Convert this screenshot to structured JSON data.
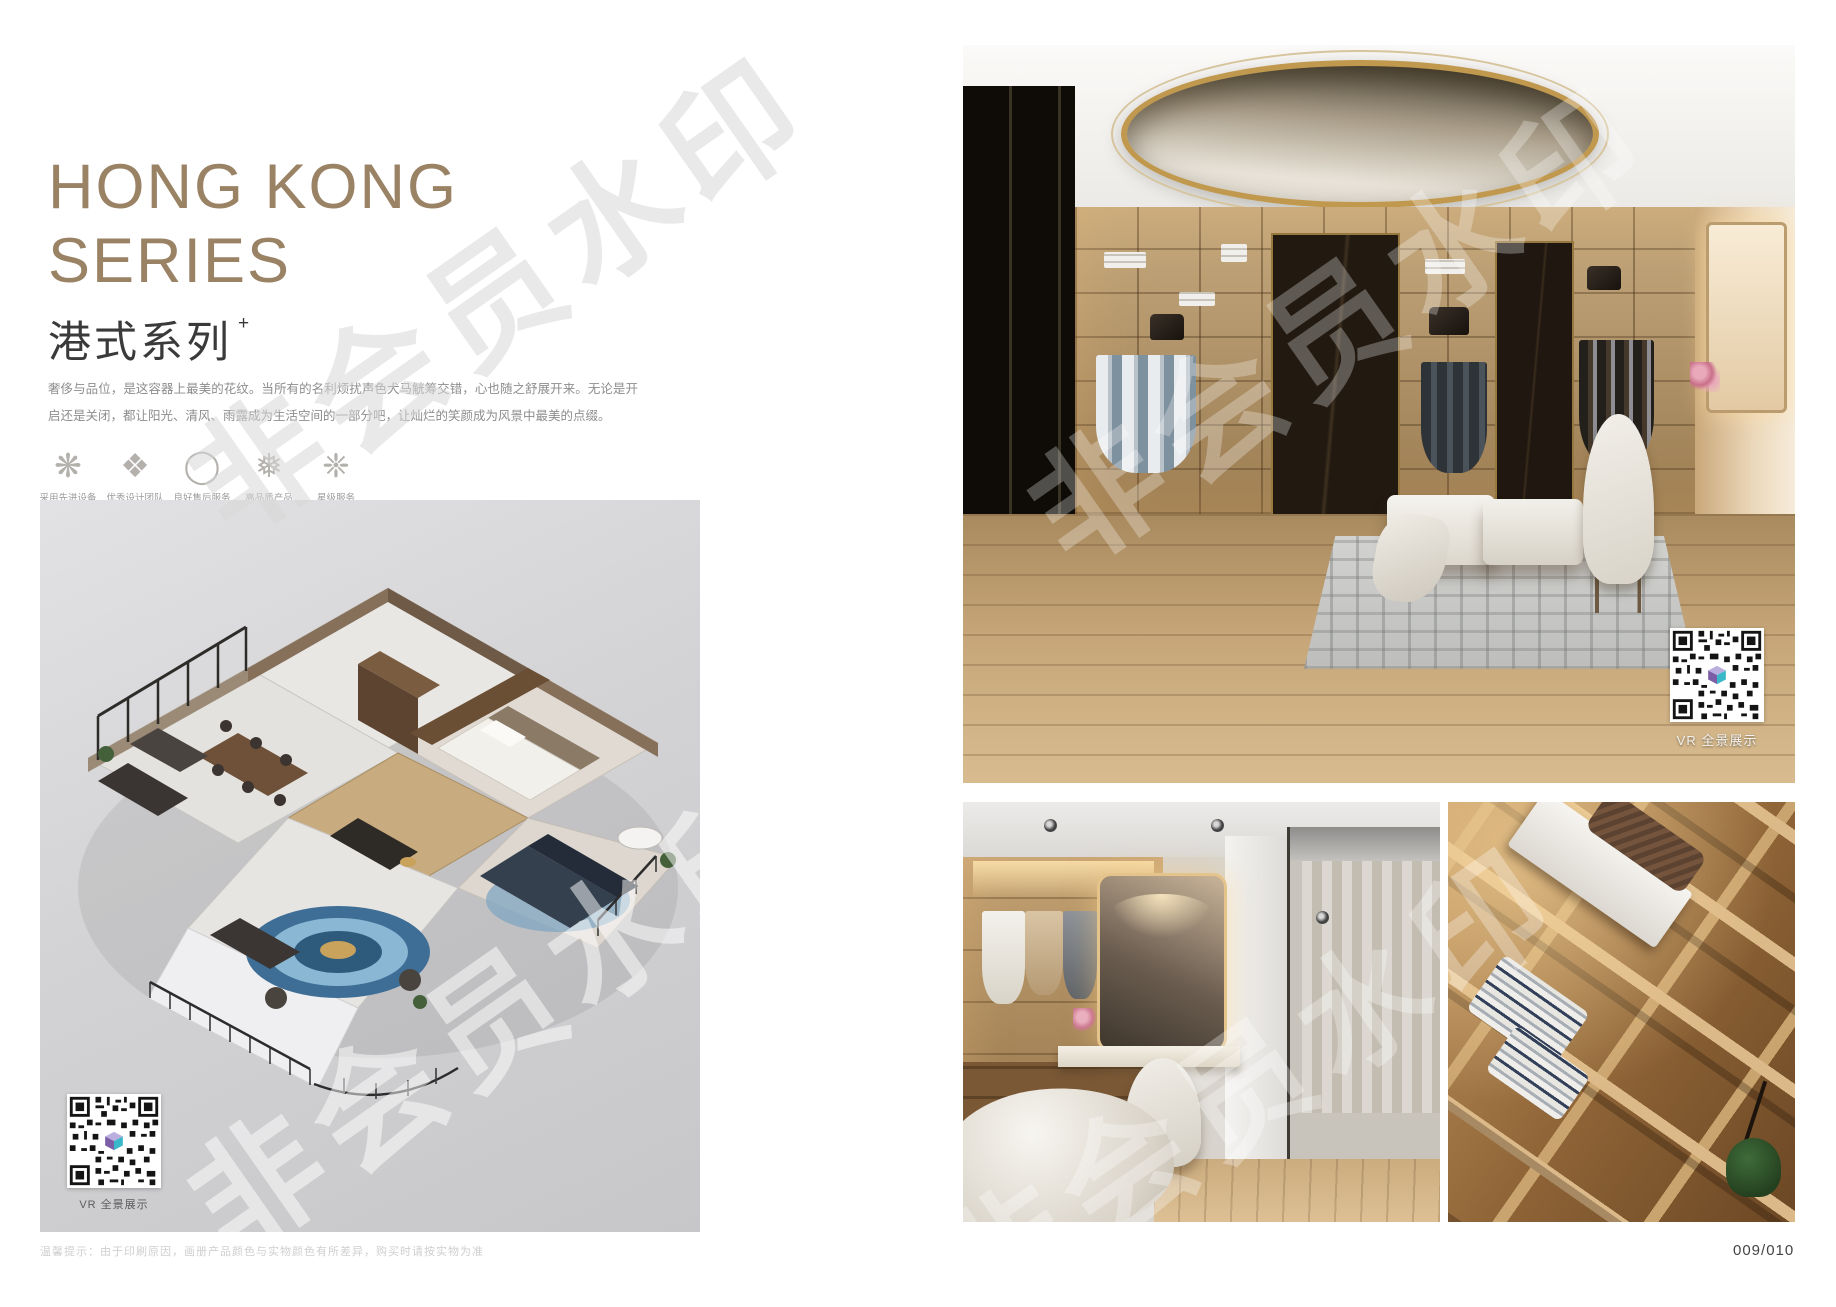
{
  "page": {
    "watermark": "非会员水印",
    "page_number": "009/010",
    "footer_tip": "温馨提示：由于印刷原因，画册产品颜色与实物颜色有所差异，购买时请按实物为准"
  },
  "header": {
    "title_en_line1": "HONG KONG",
    "title_en_line2": "SERIES",
    "title_cn": "港式系列",
    "title_superscript": "+",
    "description": "奢侈与品位，是这容器上最美的花纹。当所有的名利烦扰声色犬马觥筹交错，心也随之舒展开来。无论是开启还是关闭，都让阳光、清风、雨露成为生活空间的一部分吧，让灿烂的笑颜成为风景中最美的点缀。"
  },
  "features": [
    {
      "icon": "clover-ornament-icon",
      "glyph": "❋",
      "label": "采用先进设备"
    },
    {
      "icon": "rosette-icon",
      "glyph": "❖",
      "label": "优秀设计团队"
    },
    {
      "icon": "ring-icon",
      "glyph": "◯",
      "label": "良好售后服务"
    },
    {
      "icon": "snowflake-icon",
      "glyph": "❅",
      "label": "高品质产品"
    },
    {
      "icon": "star-ornament-icon",
      "glyph": "❈",
      "label": "星级服务"
    }
  ],
  "floor_plan": {
    "vr_caption": "VR 全景展示"
  },
  "photos": {
    "top": {
      "vr_caption": "VR 全景展示"
    }
  },
  "colors": {
    "accent_bronze": "#9a8265",
    "panel_gray": "#d2d2d4",
    "qr_cube_purple": "#7b5ea7",
    "qr_cube_teal": "#39b8c9"
  }
}
